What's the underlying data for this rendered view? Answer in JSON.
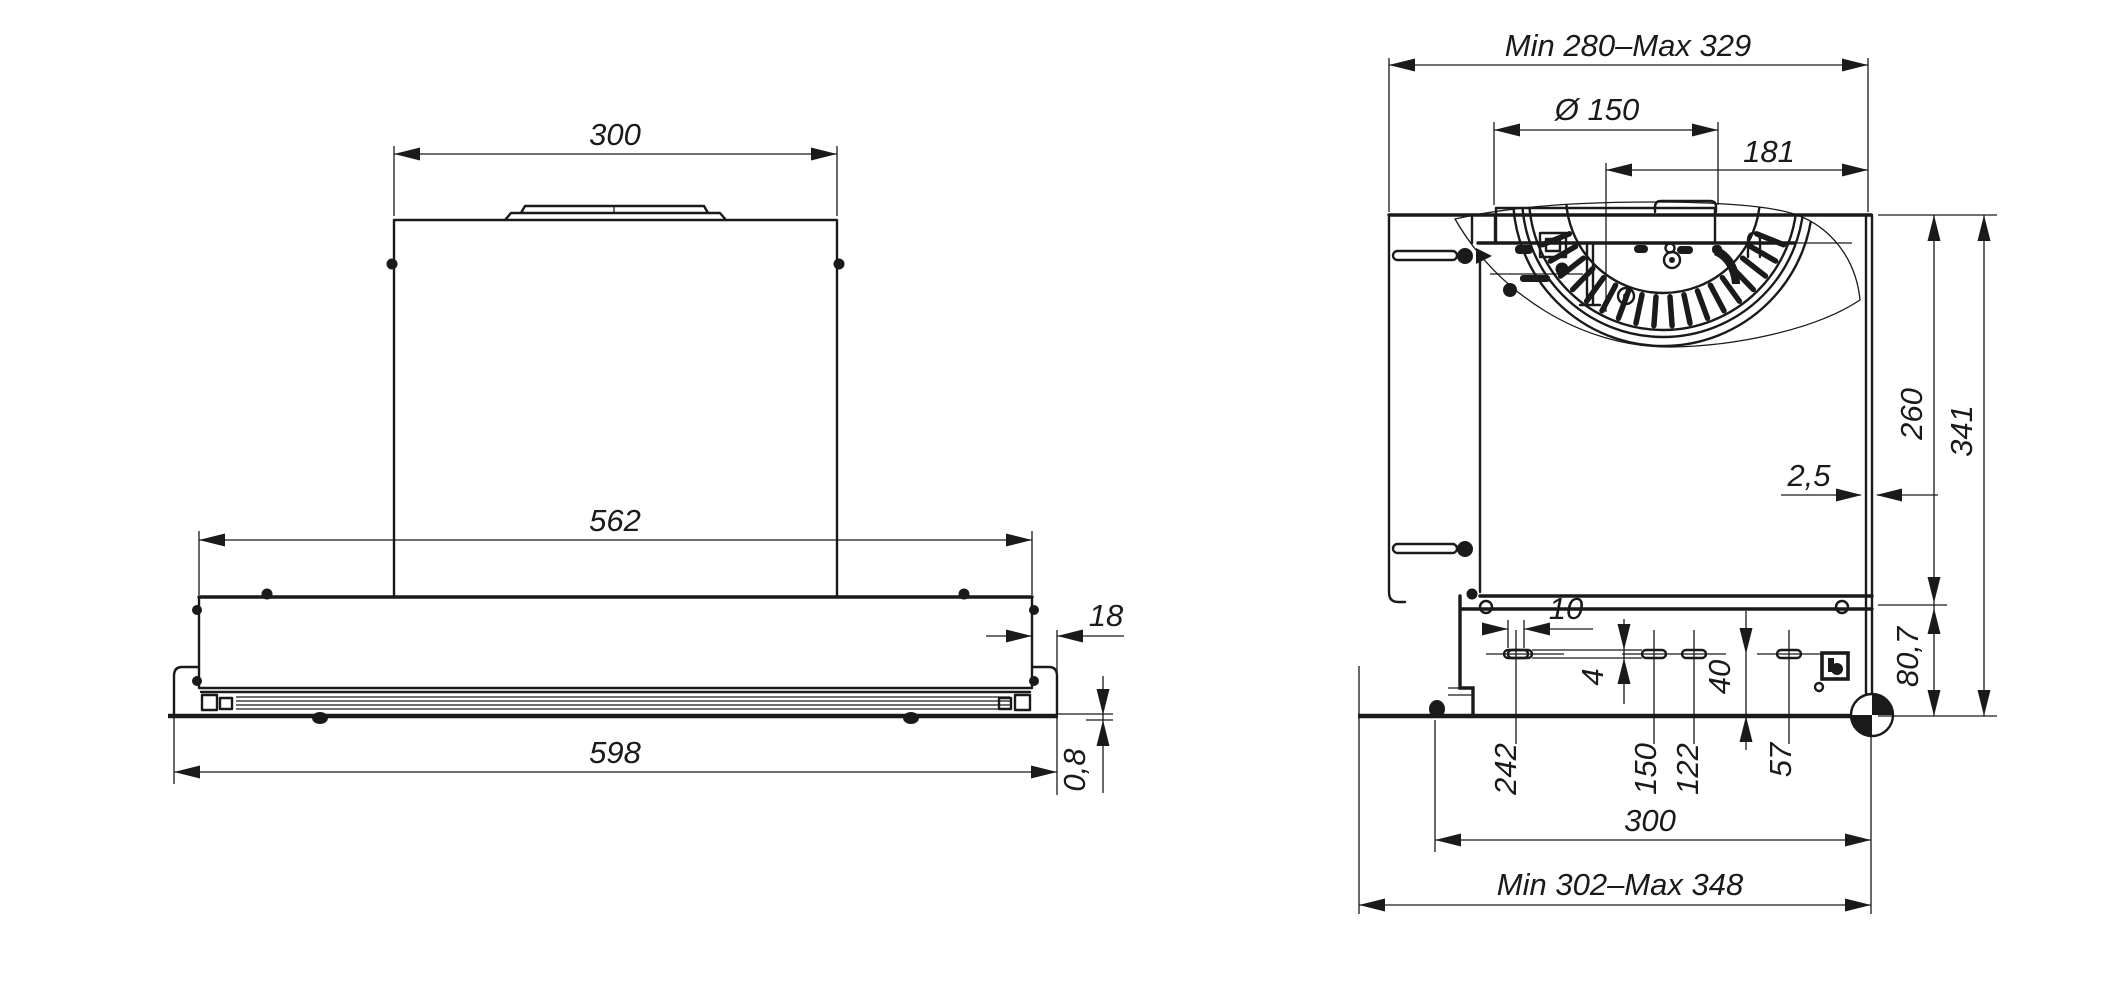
{
  "colors": {
    "line_color": "#1a1a1a",
    "background": "#ffffff"
  },
  "front_view": {
    "dim_chimney_width": "300",
    "dim_body_width": "562",
    "dim_overall_width": "598",
    "dim_visor_side_offset": "18",
    "dim_bottom_plate_thickness": "0,8"
  },
  "side_view": {
    "dim_top_depth_range": "Min 280–Max 329",
    "dim_duct_diameter": "Ø 150",
    "dim_duct_axis_to_back": "181",
    "dim_body_height": "260",
    "dim_total_height": "341",
    "dim_back_panel_gap": "2,5",
    "dim_bottom_section_height": "80,7",
    "dim_slot_length": "10",
    "dim_slot_width": "4",
    "dim_slot_to_bottom": "40",
    "dim_slot_pos_242": "242",
    "dim_slot_pos_150": "150",
    "dim_slot_pos_122": "122",
    "dim_slot_pos_57": "57",
    "dim_bottom_depth": "300",
    "dim_bottom_depth_range": "Min 302–Max 348"
  }
}
